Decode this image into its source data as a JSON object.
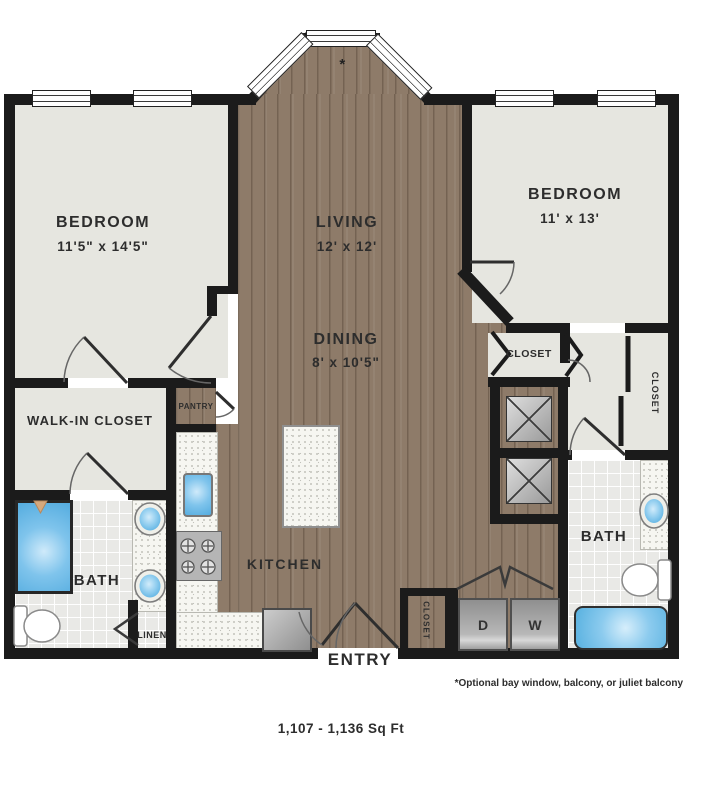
{
  "plan": {
    "area_text": "1,107 - 1,136 Sq Ft",
    "footnote": "*Optional bay window, balcony, or juliet balcony",
    "bay_asterisk": "*"
  },
  "rooms": {
    "bedroom_left": {
      "name": "BEDROOM",
      "dims": "11'5\" x 14'5\""
    },
    "living": {
      "name": "LIVING",
      "dims": "12' x 12'"
    },
    "dining": {
      "name": "DINING",
      "dims": "8' x 10'5\""
    },
    "bedroom_right": {
      "name": "BEDROOM",
      "dims": "11' x 13'"
    },
    "kitchen": {
      "name": "KITCHEN"
    },
    "pantry": {
      "name": "PANTRY"
    },
    "walk_in_closet": {
      "name": "WALK-IN CLOSET"
    },
    "bath_left": {
      "name": "BATH"
    },
    "bath_right": {
      "name": "BATH"
    },
    "linen": {
      "name": "LINEN"
    },
    "closet_bedroom2": {
      "name": "CLOSET"
    },
    "closet_hall": {
      "name": "CLOSET"
    },
    "closet_entry": {
      "name": "CLOSET"
    },
    "entry": {
      "name": "ENTRY"
    },
    "laundry": {
      "dryer": "D",
      "washer": "W"
    }
  },
  "colors": {
    "wall": "#1b1b1b",
    "wood_floor": "#8e7b69",
    "room_floor": "#e6e6e0",
    "bath_tile": "#e9e9e6",
    "counter": "#f6f6f1",
    "fixture_blue": "#5fb4e2",
    "appliance_gray": "#a9a9a9",
    "text": "#2d2d2d",
    "background": "#ffffff"
  }
}
